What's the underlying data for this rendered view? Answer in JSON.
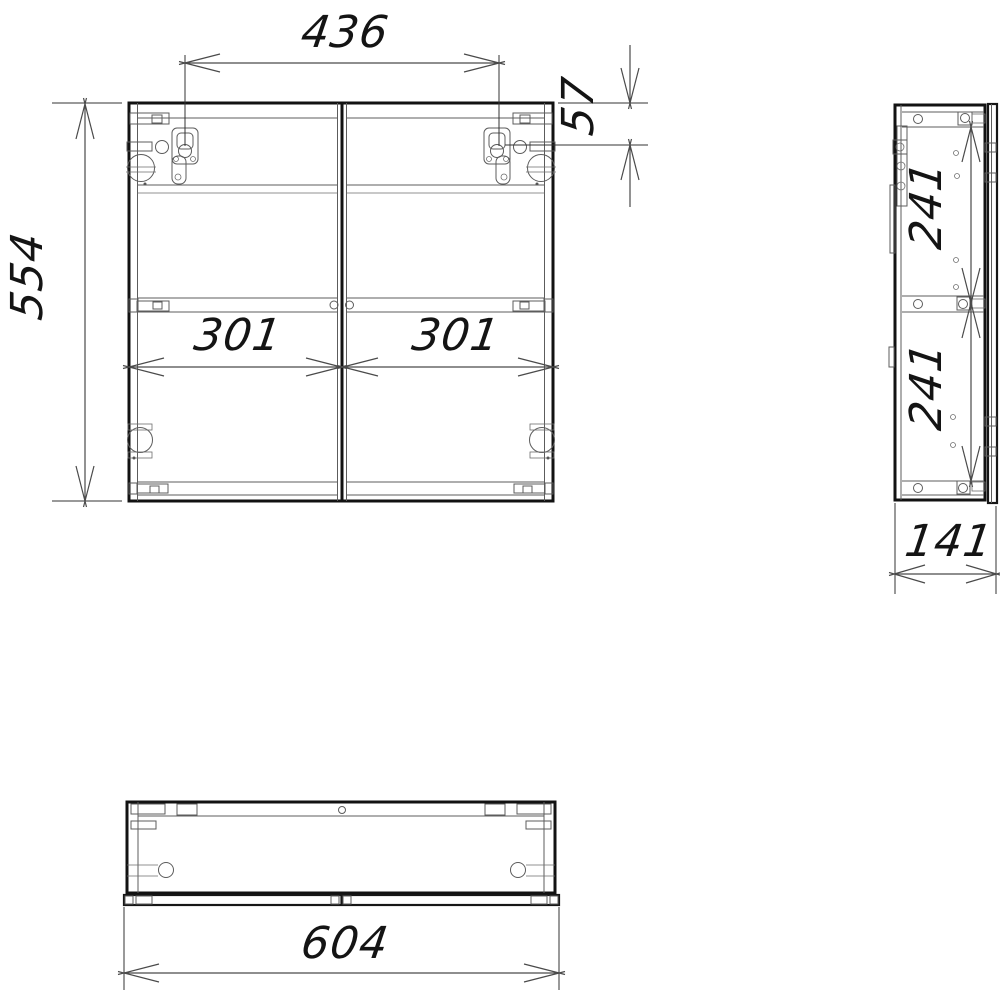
{
  "drawing": {
    "type": "technical-drawing",
    "subject": "two-door wall cabinet, three orthographic views",
    "colors": {
      "line": "#121212",
      "detail": "#5c5c5c",
      "dimension": "#4a4a4a",
      "background": "#ffffff"
    },
    "views": {
      "front": {
        "dims": {
          "hanger_spacing": "436",
          "hanger_top_offset": "57",
          "height": "554",
          "left_door_width": "301",
          "right_door_width": "301"
        }
      },
      "side": {
        "dims": {
          "upper_shelf_spacing": "241",
          "lower_shelf_spacing": "241",
          "depth": "141"
        }
      },
      "bottom": {
        "dims": {
          "width": "604"
        }
      }
    }
  }
}
